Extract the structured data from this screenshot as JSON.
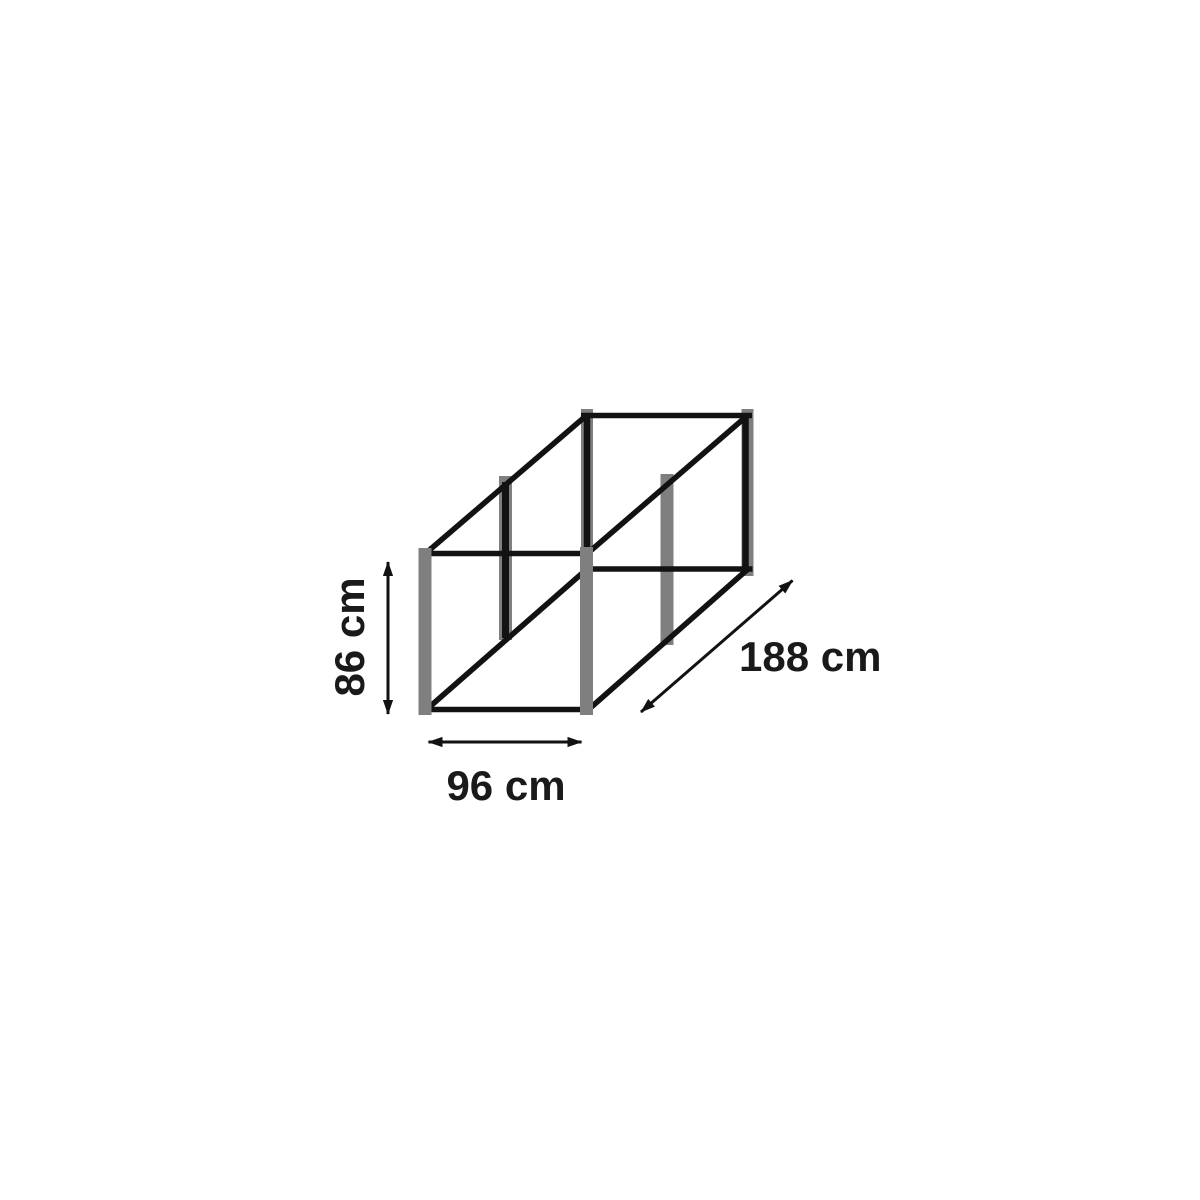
{
  "figure": {
    "background_color": "#ffffff",
    "frame_color": "#121212",
    "post_color": "#7f7f7f",
    "text_color": "#1a1a1a",
    "dimensions": {
      "height": {
        "label": "86 cm",
        "value": 86,
        "unit": "cm"
      },
      "width": {
        "label": "96 cm",
        "value": 96,
        "unit": "cm"
      },
      "depth": {
        "label": "188 cm",
        "value": 188,
        "unit": "cm"
      }
    }
  }
}
